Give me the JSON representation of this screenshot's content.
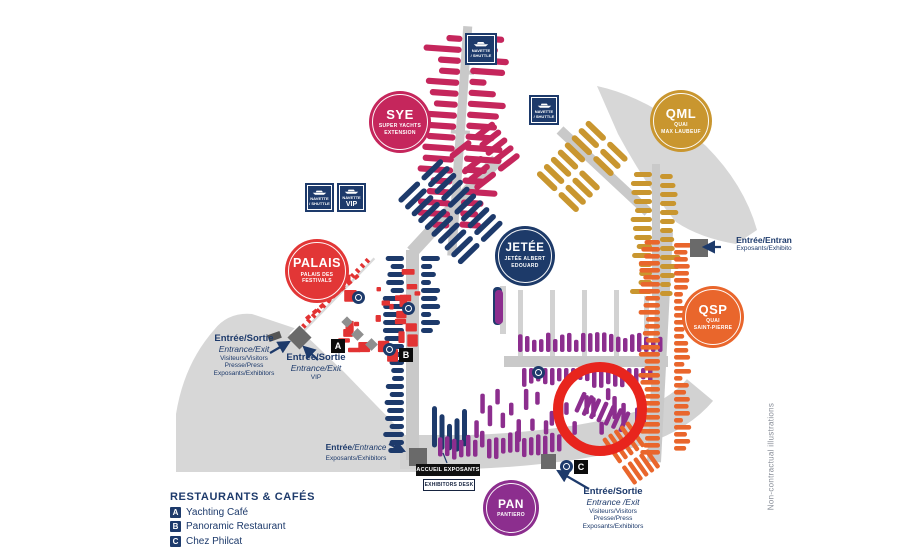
{
  "zones": [
    {
      "code": "SYE",
      "sub1": "SUPER YACHTS",
      "sub2": "EXTENSION",
      "color": "#c5265c"
    },
    {
      "code": "QML",
      "sub1": "QUAI",
      "sub2": "MAX LAUBEUF",
      "color": "#c9962f"
    },
    {
      "code": "JETÉE",
      "sub1": "JETÉE ALBERT",
      "sub2": "EDOUARD",
      "color": "#1d3a69"
    },
    {
      "code": "PALAIS",
      "sub1": "PALAIS DES",
      "sub2": "FESTIVALS",
      "color": "#e23636"
    },
    {
      "code": "QSP",
      "sub1": "QUAI",
      "sub2": "SAINT-PIERRE",
      "color": "#e9662c"
    },
    {
      "code": "PAN",
      "sub1": "PANTIERO",
      "sub2": "",
      "color": "#8c2e8e"
    }
  ],
  "shuttles": {
    "line1": "NAVETTE",
    "line2": "/ SHUTTLE",
    "vip_line1": "NAVETTE",
    "vip_line2": "VIP"
  },
  "entrances": {
    "west": {
      "lines": [
        "Entrée/Sortie",
        "Entrance/Exit",
        "Visiteurs/Visitors",
        "Presse/Press",
        "Exposants/Exhibitors"
      ]
    },
    "vip": {
      "lines": [
        "Entrée/Sortie",
        "Entrance/Exit",
        "VIP"
      ]
    },
    "east": {
      "lines": [
        "Entrée/Entran",
        "Exposants/Exhibito"
      ]
    },
    "south_center": {
      "bold": "Entrée",
      "italic": "/Entrance",
      "sub": "Exposants/Exhibitors"
    },
    "south_east": {
      "lines": [
        "Entrée/Sortie",
        "Entrance /Exit",
        "Visiteurs/Visitors",
        "Presse/Press",
        "Exposants/Exhibitors"
      ]
    }
  },
  "exhibitors_desk": {
    "line1": "ACCUEIL EXPOSANTS",
    "line2": "EXHIBITORS DESK"
  },
  "legend": {
    "title": "RESTAURANTS & CAFÉS",
    "items": [
      {
        "letter": "A",
        "label": "Yachting Café"
      },
      {
        "letter": "B",
        "label": "Panoramic Restaurant"
      },
      {
        "letter": "C",
        "label": "Chez Philcat"
      }
    ]
  },
  "note": "Non-contractual illustrations",
  "colors": {
    "crimson": "#c5265c",
    "gold": "#c9962f",
    "navy": "#1d3a6b",
    "red": "#e23333",
    "orange": "#e9662c",
    "purple": "#8c2e8e",
    "land_gray": "#d7d7d7",
    "pier_gray": "#c9c9c9",
    "entrance_gray": "#6a6a6a",
    "text_navy": "#1d3a6b",
    "annotation_red": "#e8251d",
    "note_gray": "#8a8f99"
  }
}
